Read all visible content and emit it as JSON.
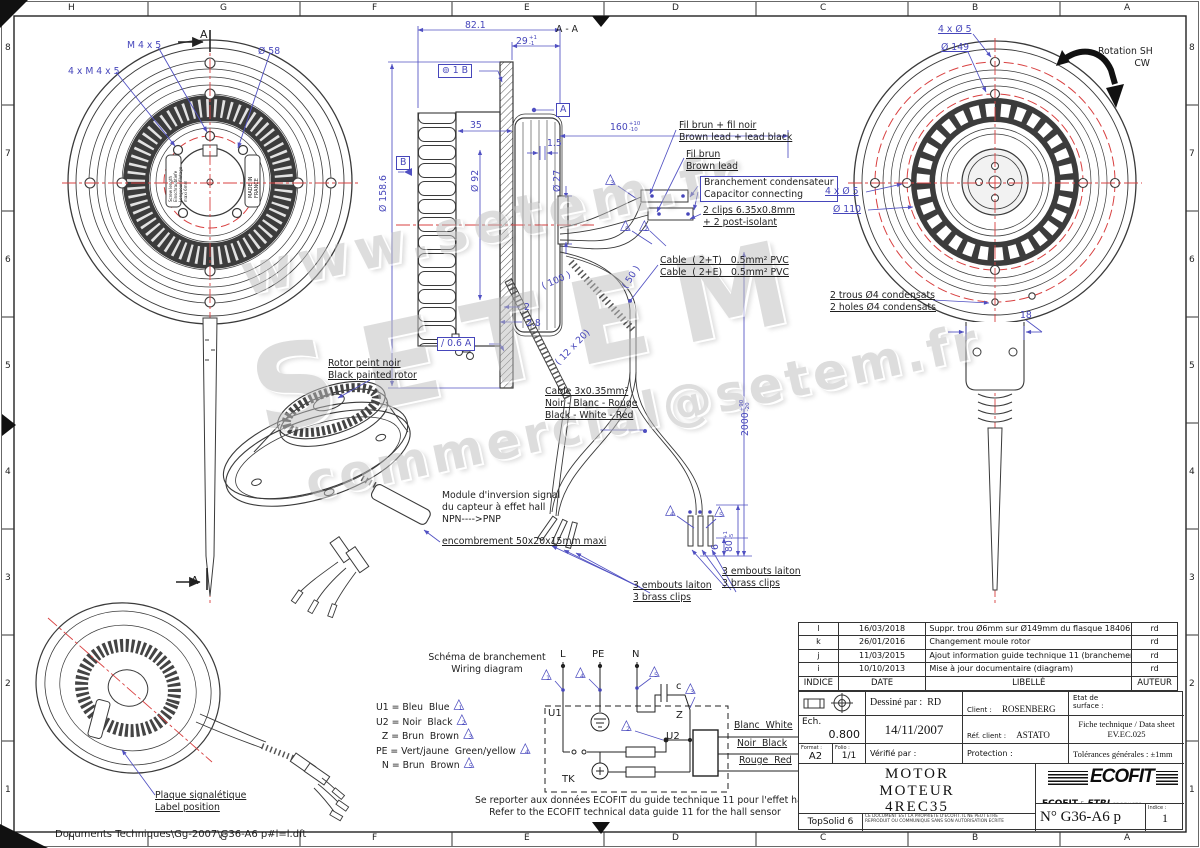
{
  "colors": {
    "dim_blue": "#4646bb",
    "line_dark": "#3a3a3a",
    "center_red": "#d84040",
    "logo_blue": "#1e44a3",
    "logo_red": "#d1232a"
  },
  "frame": {
    "letters": [
      "H",
      "G",
      "F",
      "E",
      "D",
      "C",
      "B",
      "A"
    ],
    "letter_x": [
      72,
      224,
      376,
      528,
      676,
      824,
      976,
      1128
    ],
    "numbers": [
      "8",
      "7",
      "6",
      "5",
      "4",
      "3",
      "2",
      "1"
    ],
    "number_y": [
      48,
      154,
      260,
      366,
      472,
      578,
      684,
      790
    ],
    "file_path": "Documents Techniques\\Gg-2007\\G36-A6 p#l=l.dft"
  },
  "watermarks": [
    {
      "text": "www.setem.fr",
      "x": 235,
      "y": 245,
      "size": 56,
      "ls": 6,
      "rot": -12
    },
    {
      "text": "SETEM",
      "x": 240,
      "y": 330,
      "size": 115,
      "ls": 28,
      "rot": -12
    },
    {
      "text": "commercial@setem.fr",
      "x": 300,
      "y": 455,
      "size": 50,
      "ls": 4,
      "rot": -12
    }
  ],
  "annotations": [
    {
      "n": "dim-m4x5",
      "t": "M 4 x 5",
      "x": 127,
      "y": 40
    },
    {
      "n": "dim-dia58",
      "t": "Ø 58",
      "x": 258,
      "y": 46
    },
    {
      "n": "dim-4xm4x5",
      "t": "4 x M 4 x 5",
      "x": 68,
      "y": 66
    },
    {
      "n": "section-a-top",
      "t": "A",
      "x": 200,
      "y": 28,
      "c": "k",
      "s": 11
    },
    {
      "n": "section-a-bottom",
      "t": "A",
      "x": 191,
      "y": 574,
      "c": "k",
      "s": 11
    },
    {
      "n": "plate-text-left",
      "t": "Screw length\nEinschraubtiefe\nLongueur filetage\nmaxi 6mm",
      "x": 168,
      "y": 202,
      "c": "k",
      "s": 4,
      "r": -90
    },
    {
      "n": "plate-text-right",
      "t": "MADE IN\nFRANCE",
      "x": 248,
      "y": 198,
      "c": "k",
      "s": 5,
      "r": -90
    },
    {
      "n": "dim-82-1",
      "t": "82.1",
      "x": 465,
      "y": 20
    },
    {
      "n": "dim-29",
      "t": "29",
      "x": 516,
      "y": 36,
      "tol": "+1\n-1"
    },
    {
      "n": "label-section-aa",
      "t": "A - A",
      "x": 556,
      "y": 24,
      "c": "k"
    },
    {
      "n": "gdt-frame",
      "t": "⊚ 1 B",
      "x": 438,
      "y": 64,
      "box": 1
    },
    {
      "n": "datum-a-flag",
      "t": "A",
      "x": 556,
      "y": 103,
      "box": 1
    },
    {
      "n": "dim-35",
      "t": "35",
      "x": 470,
      "y": 120
    },
    {
      "n": "dim-dia158-6",
      "t": "Ø 158.6",
      "x": 378,
      "y": 212,
      "r": -90
    },
    {
      "n": "datum-b-flag",
      "t": "B",
      "x": 396,
      "y": 156,
      "box": 1
    },
    {
      "n": "dim-dia92",
      "t": "Ø 92",
      "x": 470,
      "y": 192,
      "r": -90
    },
    {
      "n": "dim-1-5",
      "t": "1.5",
      "x": 547,
      "y": 138
    },
    {
      "n": "dim-dia27",
      "t": "Ø 27",
      "x": 552,
      "y": 192,
      "r": -90
    },
    {
      "n": "dim-160",
      "t": "160",
      "x": 610,
      "y": 122,
      "tol": "+10\n-10"
    },
    {
      "n": "dim-2",
      "t": "2",
      "x": 524,
      "y": 302
    },
    {
      "n": "dim-2-8",
      "t": "2.8",
      "x": 526,
      "y": 318
    },
    {
      "n": "runout-frame",
      "t": "/ 0.6 A",
      "x": 437,
      "y": 337,
      "box": 1
    },
    {
      "n": "dim-100",
      "t": "( 100 )",
      "x": 540,
      "y": 282,
      "r": -24
    },
    {
      "n": "dim-50",
      "t": "( 50 )",
      "x": 620,
      "y": 285,
      "r": -58
    },
    {
      "n": "dim-12x20",
      "t": "( 12 x 20)",
      "x": 553,
      "y": 360,
      "r": -46
    },
    {
      "n": "note-fil-brun-noir",
      "t": "Fil brun + fil noir\nBrown lead + lead black",
      "x": 679,
      "y": 120,
      "u": 1,
      "c": "k"
    },
    {
      "n": "note-fil-brun",
      "t": "Fil brun\nBrown lead",
      "x": 686,
      "y": 149,
      "u": 1,
      "c": "k"
    },
    {
      "n": "note-branchement",
      "t": "Branchement condensateur\nCapacitor connecting",
      "x": 700,
      "y": 176,
      "box": 1,
      "c": "k"
    },
    {
      "n": "note-2clips",
      "t": "2 clips 6.35x0.8mm\n+ 2 post-isolant",
      "x": 703,
      "y": 205,
      "u": 1,
      "c": "k"
    },
    {
      "n": "note-cable-2t",
      "t": "Cable  ( 2+T)   0.5mm² PVC\nCable  ( 2+E)   0.5mm² PVC",
      "x": 660,
      "y": 255,
      "u": 1,
      "c": "k"
    },
    {
      "n": "dim-2000",
      "t": "2000",
      "x": 740,
      "y": 436,
      "r": -90,
      "tol": "+90\n-20"
    },
    {
      "n": "note-2trous",
      "t": "2 trous Ø4 condensats\n2 holes Ø4 condensats",
      "x": 830,
      "y": 290,
      "u": 1,
      "c": "k"
    },
    {
      "n": "dim-18",
      "t": "18",
      "x": 1020,
      "y": 310
    },
    {
      "n": "note-rotor",
      "t": "Rotor peint noir\nBlack painted rotor",
      "x": 328,
      "y": 358,
      "u": 1,
      "c": "k"
    },
    {
      "n": "note-cable3x",
      "t": "Cable 3x0.35mm²\nNoir - Blanc - Rouge\nBlack - White - Red",
      "x": 545,
      "y": 386,
      "u": 1,
      "c": "k"
    },
    {
      "n": "note-module",
      "t": "Module d'inversion signal\ndu capteur à effet hall\nNPN---->PNP",
      "x": 442,
      "y": 490,
      "c": "k"
    },
    {
      "n": "note-module-enc",
      "t": "encombrement 50x20x15mm maxi",
      "x": 442,
      "y": 536,
      "u": 1,
      "c": "k"
    },
    {
      "n": "note-embouts-left",
      "t": "3 embouts laiton\n3 brass clips",
      "x": 633,
      "y": 580,
      "u": 1,
      "c": "k"
    },
    {
      "n": "note-embouts-right",
      "t": "3 embouts laiton\n3 brass clips",
      "x": 722,
      "y": 566,
      "u": 1,
      "c": "k"
    },
    {
      "n": "dim-6",
      "t": "6",
      "x": 710,
      "y": 550,
      "r": -90
    },
    {
      "n": "dim-80",
      "t": "80",
      "x": 724,
      "y": 552,
      "r": -90,
      "tol": "+1\n-5"
    },
    {
      "n": "note-plaque",
      "t": "Plaque signalétique\nLabel position",
      "x": 155,
      "y": 790,
      "u": 1,
      "c": "k"
    },
    {
      "n": "dim-4xdia5-top",
      "t": "4 x Ø 5",
      "x": 938,
      "y": 24,
      "u": 1
    },
    {
      "n": "dim-dia149",
      "t": "Ø 149",
      "x": 941,
      "y": 42,
      "u": 1
    },
    {
      "n": "label-rotation",
      "t": "Rotation SH\nCW",
      "x": 1098,
      "y": 46,
      "c": "k",
      "al": "r",
      "w": 52
    },
    {
      "n": "dim-4xdia5-mid",
      "t": "4 x Ø 5",
      "x": 825,
      "y": 186,
      "u": 1
    },
    {
      "n": "dim-dia110",
      "t": "Ø 110",
      "x": 833,
      "y": 204,
      "u": 1
    },
    {
      "n": "label-schema",
      "t": "Schéma de branchement\nWiring diagram",
      "x": 428,
      "y": 652,
      "c": "k",
      "al": "c",
      "w": 118
    },
    {
      "n": "terminal-l",
      "t": "L",
      "x": 560,
      "y": 649,
      "c": "k",
      "s": 10
    },
    {
      "n": "terminal-pe",
      "t": "PE",
      "x": 592,
      "y": 649,
      "c": "k",
      "s": 10
    },
    {
      "n": "terminal-n",
      "t": "N",
      "x": 632,
      "y": 649,
      "c": "k",
      "s": 10
    },
    {
      "n": "label-c",
      "t": "c",
      "x": 676,
      "y": 681,
      "c": "k",
      "s": 10
    },
    {
      "n": "label-u1",
      "t": "U1",
      "x": 548,
      "y": 708,
      "c": "k",
      "s": 10
    },
    {
      "n": "label-u2",
      "t": "U2",
      "x": 666,
      "y": 731,
      "c": "k",
      "s": 10
    },
    {
      "n": "label-z",
      "t": "Z",
      "x": 676,
      "y": 710,
      "c": "k",
      "s": 10
    },
    {
      "n": "label-tk",
      "t": "TK",
      "x": 562,
      "y": 774,
      "c": "k",
      "s": 10
    },
    {
      "n": "wire-blanc",
      "t": "Blanc  White",
      "x": 734,
      "y": 720,
      "u": 1,
      "c": "k"
    },
    {
      "n": "wire-noir",
      "t": "Noir  Black",
      "x": 737,
      "y": 738,
      "u": 1,
      "c": "k"
    },
    {
      "n": "wire-rouge",
      "t": "Rouge  Red",
      "x": 739,
      "y": 755,
      "u": 1,
      "c": "k"
    },
    {
      "n": "note-hall",
      "t": "Se reporter aux données ECOFIT du guide technique 11 pour l'effet hall\nRefer to the ECOFIT technical data guide 11 for the hall sensor",
      "x": 475,
      "y": 795,
      "c": "k",
      "al": "c",
      "w": 320
    },
    {
      "n": "file-path",
      "t": "Documents Techniques\\Gg-2007\\G36-A6 p#l=l.dft",
      "x": 55,
      "y": 829,
      "c": "k",
      "s": 10
    }
  ],
  "triangles": [
    {
      "v": "3",
      "x": 605,
      "y": 175
    },
    {
      "v": "5",
      "x": 620,
      "y": 221
    },
    {
      "v": "2",
      "x": 639,
      "y": 221
    },
    {
      "v": "4",
      "x": 665,
      "y": 506
    },
    {
      "v": "5",
      "x": 714,
      "y": 507
    },
    {
      "v": "1",
      "x": 541,
      "y": 670
    },
    {
      "v": "4",
      "x": 575,
      "y": 668
    },
    {
      "v": "5",
      "x": 649,
      "y": 667
    },
    {
      "v": "3",
      "x": 685,
      "y": 684
    },
    {
      "v": "2",
      "x": 621,
      "y": 721
    }
  ],
  "legend": {
    "x": 376,
    "y": 700,
    "row_h": 14.5,
    "rows": [
      {
        "t": "U1 = Bleu  Blue",
        "v": "1"
      },
      {
        "t": "U2 = Noir  Black",
        "v": "2"
      },
      {
        "t": "  Z = Brun  Brown",
        "v": "3"
      },
      {
        "t": "PE = Vert/jaune  Green/yellow",
        "v": "4"
      },
      {
        "t": "  N = Brun  Brown",
        "v": "5"
      }
    ]
  },
  "revision_table": {
    "headers": {
      "indice": "INDICE",
      "date": "DATE",
      "libelle": "LIBELLÉ",
      "auteur": "AUTEUR"
    },
    "rows": [
      {
        "indice": "l",
        "date": "16/03/2018",
        "libelle": "Suppr. trou Ø6mm sur Ø149mm du flasque 18406",
        "auteur": "rd"
      },
      {
        "indice": "k",
        "date": "26/01/2016",
        "libelle": "Changement moule rotor",
        "auteur": "rd"
      },
      {
        "indice": "j",
        "date": "11/03/2015",
        "libelle": "Ajout information guide technique 11 (branchement contrôle effet hall)",
        "auteur": "rd"
      },
      {
        "indice": "i",
        "date": "10/10/2013",
        "libelle": "Mise à jour documentaire (diagram)",
        "auteur": "rd"
      }
    ]
  },
  "title_block": {
    "dessine_label": "Dessiné par :",
    "dessine_value": "RD",
    "client_label": "Client :",
    "client_value": "ROSENBERG France",
    "etat": "Etat de\nsurface :",
    "ech_label": "Ech.",
    "ech_value": "0.800",
    "date": "14/11/2007",
    "ref_label": "Réf. client :",
    "ref_value": "ASTATO",
    "fiche_line1": "Fiche technique / Data sheet",
    "fiche_line2": "EV.EC.025",
    "format_label": "Format :",
    "format_value": "A2",
    "folio_label": "Folio :",
    "folio_value": "1/1",
    "verifie": "Vérifié par :",
    "protection": "Protection :",
    "tolerances": "Tolérances générales : ±1mm",
    "product_lines": [
      "MOTOR",
      "MOTEUR",
      "4REC35"
    ],
    "cad": "TopSolid 6",
    "disclaimer1": "CE DOCUMENT EST LA PROPRIETE D'ECOFIT. IL NE PEUT ETRE",
    "disclaimer2": "REPRODUIT OU COMMUNIQUE SANS SON AUTORISATION ECRITE",
    "doc_number": "N° G36-A6 p",
    "indice_label": "Indice :",
    "indice_value": "1"
  },
  "logo": {
    "brand": "ECOFIT",
    "sub_brand_1": "ECOFIT",
    "amp": "&",
    "sub_brand_2": "ETRI",
    "sub_brand_3": "PRODUCTS"
  }
}
